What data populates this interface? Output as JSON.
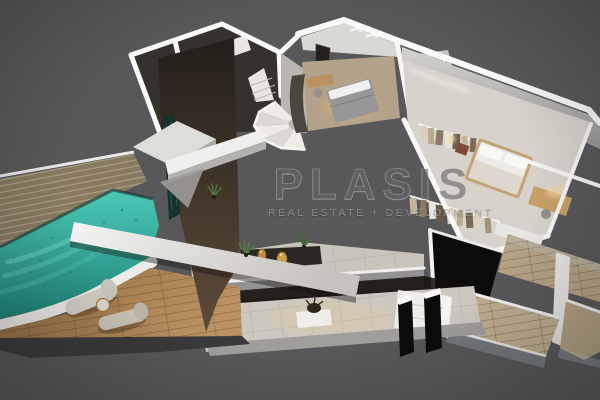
{
  "meta": {
    "type": "3d-floorplan-render",
    "description": "Isometric cutaway 3D render of a duplex apartment with pool terrace, watermarked marketing image"
  },
  "watermark": {
    "brand": "PLASIS",
    "tagline": "REAL ESTATE + DEVELOPMENT"
  },
  "colors": {
    "background": "#58585a",
    "wall_cap": "#f8f7f5",
    "wall_face": "#c7c5c2",
    "dark_floor": "#35312d",
    "facade_wood": "#4a3e33",
    "pool_water": "#4cc8b6",
    "pool_deep": "#1c8376",
    "deck_wood": "#a67c4e",
    "tile_floor": "#ccc8c0",
    "warm_light": "#e7c78e",
    "black_accent": "#0b0b0b"
  },
  "scene": {
    "features": [
      "swimming pool",
      "wood deck",
      "sun loungers",
      "side table",
      "spiral staircase",
      "bedroom with bed and desk",
      "bathroom with glass shower",
      "master bedroom",
      "walk-in closet with hanging clothes",
      "study desk with lamp",
      "living room with sofa and coffee table",
      "terrace with rug and vases",
      "balconies with glass railings",
      "black privacy panels",
      "planted facade"
    ]
  }
}
